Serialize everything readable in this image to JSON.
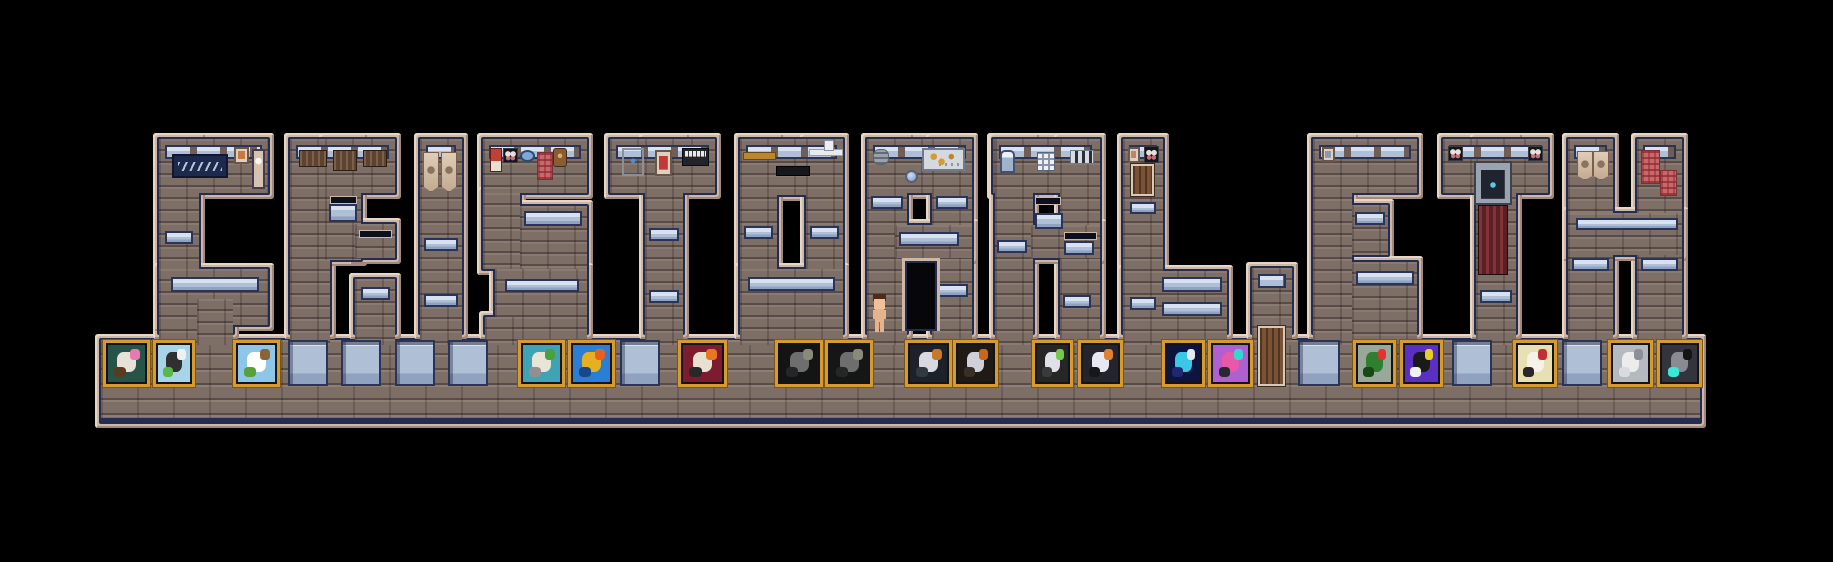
{
  "word": "CRISTOBAL.ETH",
  "palette": {
    "bg": "#000000",
    "beige": "#cdb8a7",
    "beigeLight": "#e6d6c6",
    "beigeShadow": "#a18878",
    "navy": "#242d51",
    "brick": "#7d6e66",
    "brickDark": "#5a4c46",
    "brickLight": "#8f7f76",
    "glass": "#aebfd6",
    "glassTop": "#d7e1ef",
    "glassDark": "#2a3458",
    "glassMid": "#8fa2c0",
    "gold": "#d79a2e",
    "goldDark": "#7a5518"
  },
  "letters": [
    {
      "ch": "C",
      "segs": [
        [
          159,
          139,
          109,
          54
        ],
        [
          159,
          139,
          40,
          194
        ],
        [
          159,
          269,
          109,
          56
        ],
        [
          197,
          299,
          36,
          34
        ]
      ],
      "strips": [
        [
          165,
          145,
          97
        ]
      ],
      "wins": [
        [
          171,
          277,
          88,
          15
        ],
        [
          165,
          231,
          28,
          13
        ]
      ],
      "deco": [
        {
          "t": "sign",
          "r": [
            172,
            154,
            56,
            24
          ]
        },
        {
          "t": "pic",
          "r": [
            234,
            147,
            15,
            17
          ],
          "c": "#c87840"
        },
        {
          "t": "clock",
          "r": [
            252,
            149,
            13,
            40
          ]
        }
      ]
    },
    {
      "ch": "R",
      "segs": [
        [
          290,
          139,
          105,
          54
        ],
        [
          290,
          139,
          40,
          194
        ],
        [
          325,
          139,
          36,
          121
        ],
        [
          355,
          224,
          40,
          34
        ],
        [
          355,
          279,
          40,
          54
        ]
      ],
      "strips": [
        [
          296,
          145,
          93
        ]
      ],
      "wins": [
        [
          329,
          204,
          28,
          18
        ],
        [
          361,
          287,
          29,
          13
        ]
      ],
      "deco": [
        {
          "t": "cab",
          "r": [
            299,
            150,
            28,
            17
          ]
        },
        {
          "t": "cab",
          "r": [
            333,
            150,
            24,
            21
          ]
        },
        {
          "t": "cab",
          "r": [
            363,
            150,
            24,
            17
          ]
        },
        {
          "t": "dslot",
          "r": [
            330,
            196,
            27,
            8
          ]
        },
        {
          "t": "dslot",
          "r": [
            359,
            230,
            33,
            8
          ]
        }
      ]
    },
    {
      "ch": "I",
      "segs": [
        [
          420,
          139,
          42,
          194
        ]
      ],
      "strips": [
        [
          426,
          145,
          30
        ]
      ],
      "wins": [
        [
          424,
          238,
          34,
          13
        ],
        [
          424,
          294,
          34,
          13
        ]
      ],
      "deco": [
        {
          "t": "banner",
          "r": [
            423,
            152,
            14,
            38
          ]
        },
        {
          "t": "banner",
          "r": [
            441,
            152,
            14,
            38
          ]
        }
      ]
    },
    {
      "ch": "S",
      "segs": [
        [
          483,
          139,
          104,
          54
        ],
        [
          483,
          193,
          37,
          76
        ],
        [
          520,
          206,
          67,
          63
        ],
        [
          495,
          269,
          92,
          64
        ],
        [
          485,
          317,
          37,
          16
        ]
      ],
      "strips": [
        [
          489,
          145,
          92
        ]
      ],
      "wins": [
        [
          524,
          211,
          58,
          15
        ],
        [
          505,
          279,
          74,
          13
        ]
      ],
      "deco": [
        {
          "t": "flag",
          "r": [
            490,
            148,
            12,
            24
          ]
        },
        {
          "t": "butterfly",
          "r": [
            503,
            148,
            15,
            15
          ]
        },
        {
          "t": "plate",
          "r": [
            520,
            150,
            15,
            12
          ]
        },
        {
          "t": "tapestry",
          "r": [
            537,
            152,
            14,
            26
          ]
        },
        {
          "t": "satchel",
          "r": [
            553,
            148,
            12,
            17
          ]
        }
      ]
    },
    {
      "ch": "T",
      "segs": [
        [
          610,
          139,
          105,
          54
        ],
        [
          645,
          139,
          38,
          194
        ]
      ],
      "strips": [
        [
          616,
          145,
          93
        ]
      ],
      "wins": [
        [
          649,
          228,
          30,
          13
        ],
        [
          649,
          290,
          30,
          13
        ]
      ],
      "deco": [
        {
          "t": "fridge",
          "r": [
            622,
            148,
            22,
            28
          ]
        },
        {
          "t": "pic",
          "r": [
            655,
            150,
            17,
            26
          ],
          "c": "#c03838"
        },
        {
          "t": "piano",
          "r": [
            682,
            148,
            25,
            16
          ]
        }
      ]
    },
    {
      "ch": "O",
      "segs": [
        [
          740,
          139,
          103,
          56
        ],
        [
          740,
          139,
          37,
          194
        ],
        [
          806,
          139,
          37,
          194
        ],
        [
          740,
          269,
          103,
          64
        ]
      ],
      "strips": [
        [
          746,
          145,
          91
        ]
      ],
      "wins": [
        [
          744,
          226,
          29,
          13
        ],
        [
          810,
          226,
          29,
          13
        ],
        [
          748,
          277,
          87,
          14
        ]
      ],
      "deco": [
        {
          "t": "rail",
          "r": [
            743,
            152,
            31,
            6
          ]
        },
        {
          "t": "tableblack",
          "r": [
            776,
            166,
            32,
            8
          ]
        },
        {
          "t": "shelfwhite",
          "r": [
            809,
            149,
            32,
            5
          ]
        },
        {
          "t": "whiteitem",
          "r": [
            824,
            140,
            8,
            9
          ]
        }
      ]
    },
    {
      "ch": "B",
      "segs": [
        [
          867,
          139,
          105,
          54
        ],
        [
          867,
          139,
          40,
          194
        ],
        [
          932,
          139,
          40,
          194
        ],
        [
          895,
          225,
          77,
          33
        ]
      ],
      "strips": [
        [
          873,
          145,
          93
        ]
      ],
      "wins": [
        [
          871,
          196,
          32,
          13
        ],
        [
          936,
          196,
          32,
          13
        ],
        [
          899,
          232,
          60,
          14
        ],
        [
          936,
          284,
          32,
          13
        ]
      ],
      "deco": [
        {
          "t": "vent",
          "r": [
            873,
            149,
            14,
            14
          ]
        },
        {
          "t": "porthole",
          "r": [
            905,
            170,
            13,
            13
          ]
        },
        {
          "t": "billboard",
          "r": [
            922,
            148,
            43,
            23
          ]
        },
        {
          "t": "doorway",
          "r": [
            902,
            258,
            38,
            73
          ]
        }
      ]
    },
    {
      "ch": "A",
      "segs": [
        [
          993,
          139,
          105,
          54
        ],
        [
          995,
          139,
          38,
          194
        ],
        [
          1060,
          139,
          40,
          194
        ],
        [
          1031,
          225,
          69,
          33
        ]
      ],
      "strips": [
        [
          999,
          145,
          93
        ]
      ],
      "wins": [
        [
          1035,
          213,
          28,
          16
        ],
        [
          1064,
          241,
          30,
          14
        ],
        [
          1063,
          295,
          28,
          13
        ],
        [
          997,
          240,
          30,
          13
        ]
      ],
      "deco": [
        {
          "t": "bluedoor",
          "r": [
            1000,
            150,
            15,
            23
          ]
        },
        {
          "t": "lattice",
          "r": [
            1037,
            152,
            18,
            19
          ]
        },
        {
          "t": "slots",
          "r": [
            1070,
            150,
            24,
            14
          ]
        },
        {
          "t": "dslot",
          "r": [
            1035,
            197,
            26,
            8
          ]
        },
        {
          "t": "dslot",
          "r": [
            1064,
            232,
            33,
            8
          ]
        }
      ]
    },
    {
      "ch": "L",
      "segs": [
        [
          1123,
          139,
          40,
          194
        ],
        [
          1123,
          271,
          104,
          62
        ]
      ],
      "strips": [
        [
          1129,
          145,
          28
        ]
      ],
      "wins": [
        [
          1130,
          202,
          26,
          12
        ],
        [
          1130,
          297,
          26,
          13
        ],
        [
          1162,
          277,
          60,
          15
        ],
        [
          1162,
          302,
          60,
          14
        ]
      ],
      "deco": [
        {
          "t": "pic",
          "r": [
            1128,
            147,
            12,
            16
          ],
          "c": "#b88868"
        },
        {
          "t": "butterfly",
          "r": [
            1144,
            146,
            15,
            17
          ]
        },
        {
          "t": "door",
          "r": [
            1131,
            164,
            23,
            32
          ]
        }
      ]
    },
    {
      "ch": "dot",
      "segs": [
        [
          1252,
          268,
          40,
          65
        ]
      ],
      "strips": [
        [
          1258,
          274,
          28
        ]
      ],
      "wins": [],
      "deco": []
    },
    {
      "ch": "E",
      "segs": [
        [
          1313,
          139,
          104,
          54
        ],
        [
          1313,
          139,
          39,
          194
        ],
        [
          1352,
          205,
          36,
          50
        ],
        [
          1352,
          262,
          65,
          71
        ]
      ],
      "strips": [
        [
          1319,
          145,
          92
        ]
      ],
      "wins": [
        [
          1355,
          212,
          30,
          13
        ],
        [
          1356,
          271,
          58,
          14
        ]
      ],
      "deco": [
        {
          "t": "pic",
          "r": [
            1322,
            147,
            13,
            15
          ],
          "c": "#8898b8"
        }
      ]
    },
    {
      "ch": "T2",
      "segs": [
        [
          1443,
          139,
          105,
          54
        ],
        [
          1476,
          139,
          40,
          194
        ]
      ],
      "strips": [
        [
          1449,
          145,
          93
        ]
      ],
      "wins": [
        [
          1480,
          290,
          32,
          13
        ]
      ],
      "deco": [
        {
          "t": "butterfly",
          "r": [
            1448,
            146,
            15,
            15
          ]
        },
        {
          "t": "butterfly",
          "r": [
            1528,
            146,
            15,
            15
          ]
        },
        {
          "t": "machine",
          "r": [
            1474,
            161,
            38,
            44
          ]
        },
        {
          "t": "curtain",
          "r": [
            1478,
            205,
            30,
            70
          ]
        }
      ]
    },
    {
      "ch": "H",
      "segs": [
        [
          1568,
          139,
          45,
          194
        ],
        [
          1637,
          139,
          45,
          194
        ],
        [
          1568,
          213,
          114,
          42
        ]
      ],
      "strips": [
        [
          1574,
          145,
          33
        ],
        [
          1643,
          145,
          33
        ]
      ],
      "wins": [
        [
          1572,
          258,
          37,
          13
        ],
        [
          1641,
          258,
          37,
          13
        ],
        [
          1576,
          218,
          102,
          12
        ]
      ],
      "deco": [
        {
          "t": "banner",
          "r": [
            1577,
            151,
            14,
            27
          ]
        },
        {
          "t": "banner",
          "r": [
            1593,
            151,
            14,
            27
          ]
        },
        {
          "t": "tapestry",
          "r": [
            1641,
            150,
            17,
            32
          ]
        },
        {
          "t": "tapestry",
          "r": [
            1660,
            170,
            15,
            24
          ]
        }
      ]
    }
  ],
  "base": {
    "r": [
      95,
      334,
      1611,
      94
    ],
    "windows": [
      [
        288,
        340,
        40,
        46
      ],
      [
        341,
        340,
        40,
        46
      ],
      [
        395,
        340,
        40,
        46
      ],
      [
        448,
        340,
        40,
        46
      ],
      [
        620,
        340,
        40,
        46
      ],
      [
        1298,
        340,
        42,
        46
      ],
      [
        1452,
        340,
        40,
        46
      ],
      [
        1562,
        340,
        40,
        46
      ]
    ],
    "door": [
      1258,
      326,
      27,
      60
    ],
    "paintings": [
      {
        "label": "witch-portrait",
        "x": 103,
        "w": 47,
        "bg": "#275448",
        "m": [
          "#e8e2d6",
          "#e87ab0",
          "#5a3a20"
        ]
      },
      {
        "label": "graffiti-art",
        "x": 153,
        "w": 42,
        "bg": "#a8d4ea",
        "m": [
          "#303030",
          "#f0f0f0",
          "#58b848"
        ]
      },
      {
        "label": "sky-island",
        "x": 233,
        "w": 47,
        "bg": "#8ec6ea",
        "m": [
          "#ffffff",
          "#8a6434",
          "#58a038"
        ]
      },
      {
        "label": "treasure-chest",
        "x": 518,
        "w": 47,
        "bg": "#3fa3b5",
        "m": [
          "#e8e4d8",
          "#48a040",
          "#909090"
        ]
      },
      {
        "label": "goggle-duck",
        "x": 568,
        "w": 47,
        "bg": "#2a7fd4",
        "m": [
          "#e8b020",
          "#e86020",
          "#184888"
        ]
      },
      {
        "label": "skull-flames",
        "x": 678,
        "w": 49,
        "bg": "#7e1b2f",
        "m": [
          "#e8e0d0",
          "#e87820",
          "#282828"
        ]
      },
      {
        "label": "elephant-bust-1",
        "x": 775,
        "w": 48,
        "bg": "#141414",
        "m": [
          "#6e6e6e",
          "#8a8a78",
          "#262626"
        ]
      },
      {
        "label": "elephant-bust-2",
        "x": 825,
        "w": 48,
        "bg": "#161616",
        "m": [
          "#6e6e6e",
          "#8a8a78",
          "#262626"
        ]
      },
      {
        "label": "pirate-parrot",
        "x": 905,
        "w": 47,
        "bg": "#1c2228",
        "m": [
          "#d8d8e0",
          "#c87828",
          "#303840"
        ]
      },
      {
        "label": "orange-robot",
        "x": 953,
        "w": 45,
        "bg": "#201a14",
        "m": [
          "#d0d0d8",
          "#c86820",
          "#383028"
        ]
      },
      {
        "label": "blade-figures",
        "x": 1032,
        "w": 41,
        "bg": "#262626",
        "m": [
          "#e0e0e8",
          "#78c848",
          "#3a3a3a"
        ]
      },
      {
        "label": "fox-in-suit",
        "x": 1078,
        "w": 45,
        "bg": "#24242c",
        "m": [
          "#e8e8f0",
          "#e08030",
          "#16161c"
        ]
      },
      {
        "label": "blue-potion",
        "x": 1162,
        "w": 43,
        "bg": "#0d1440",
        "m": [
          "#3ac8e8",
          "#e8e8f0",
          "#202870"
        ]
      },
      {
        "label": "pink-cat-robot",
        "x": 1208,
        "w": 45,
        "bg": "#b05fd0",
        "m": [
          "#e858a8",
          "#30d8d0",
          "#282830"
        ]
      },
      {
        "label": "green-blob",
        "x": 1353,
        "w": 43,
        "bg": "#9aa89a",
        "m": [
          "#2e8030",
          "#e83030",
          "#184818"
        ]
      },
      {
        "label": "purple-rabbit",
        "x": 1400,
        "w": 43,
        "bg": "#5b2fc4",
        "m": [
          "#1a1a1a",
          "#e8d020",
          "#f0f0f0"
        ]
      },
      {
        "label": "goat-skull",
        "x": 1513,
        "w": 44,
        "bg": "#e7e0b2",
        "m": [
          "#f6f2ea",
          "#c03030",
          "#282828"
        ]
      },
      {
        "label": "crashed-ship",
        "x": 1608,
        "w": 45,
        "bg": "#b4bac0",
        "m": [
          "#ececec",
          "#8a9098",
          "#d8dce0"
        ]
      },
      {
        "label": "gray-punk",
        "x": 1657,
        "w": 45,
        "bg": "#34343c",
        "m": [
          "#8a8a92",
          "#141414",
          "#38e8d8"
        ]
      }
    ],
    "paintingY": 340,
    "paintingH": 47
  },
  "character": {
    "x": 872,
    "y": 294,
    "w": 15,
    "h": 38,
    "skin": "#e6b48c",
    "skinLight": "#f0c09a",
    "hair": "#4a2c18"
  }
}
